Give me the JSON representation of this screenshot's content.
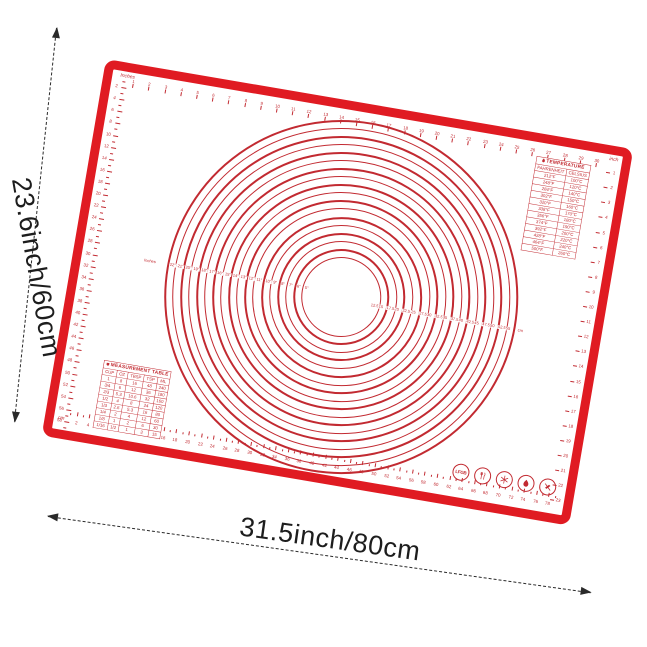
{
  "dimensions": {
    "width_label": "31.5inch/80cm",
    "height_label": "23.6inch/60cm"
  },
  "colors": {
    "mat_red": "#e01b22",
    "print_red": "#c22a31",
    "dimension_text": "#1d1d1d"
  },
  "rulers": {
    "top": {
      "unit_label": "Inches",
      "numbers": [
        1,
        2,
        3,
        4,
        5,
        6,
        7,
        8,
        9,
        10,
        11,
        12,
        13,
        14,
        15,
        16,
        17,
        18,
        19,
        20,
        21,
        22,
        23,
        24,
        25,
        26,
        27,
        28,
        29,
        30
      ]
    },
    "bottom": {
      "unit_label": "cm",
      "numbers": [
        2,
        4,
        6,
        8,
        10,
        12,
        14,
        16,
        18,
        20,
        22,
        24,
        26,
        28,
        30,
        32,
        34,
        36,
        38,
        40,
        42,
        44,
        46,
        48,
        50,
        52,
        54,
        56,
        58,
        60,
        62,
        64,
        66,
        68,
        70,
        72,
        74,
        76,
        78
      ]
    },
    "left": {
      "unit_label": "cm",
      "numbers": [
        2,
        4,
        6,
        8,
        10,
        12,
        14,
        16,
        18,
        20,
        22,
        24,
        26,
        28,
        30,
        32,
        34,
        36,
        38,
        40,
        42,
        44,
        46,
        48,
        50,
        52,
        54,
        56,
        58
      ]
    },
    "right": {
      "unit_label": "inch",
      "numbers": [
        1,
        2,
        3,
        4,
        5,
        6,
        7,
        8,
        9,
        10,
        11,
        12,
        13,
        14,
        15,
        16,
        17,
        18,
        19,
        20,
        21,
        22,
        23
      ]
    }
  },
  "circles": {
    "axis_prefix_label": "Inches",
    "inch_labels": [
      "22\"",
      "21\"",
      "20\"",
      "19\"",
      "18\"",
      "17\"",
      "16\"",
      "15\"",
      "14\"",
      "13\"",
      "12\"",
      "11\"",
      "10\"",
      "9\"",
      "8\"",
      "7\"",
      "6\"",
      "5\""
    ],
    "cm_labels": [
      "12.5",
      "15",
      "17.5",
      "20",
      "22.5",
      "25",
      "27.5",
      "30",
      "32.5",
      "35",
      "37.5",
      "40",
      "42.5",
      "45",
      "47.5",
      "50",
      "52.5",
      "55"
    ],
    "cm_suffix": "cm",
    "count": 18
  },
  "temperature_table": {
    "icon": "flame-icon",
    "title": "TEMPERATURE",
    "columns": [
      "FAHRENHEIT",
      "CELSIUS"
    ],
    "rows": [
      [
        "212°F",
        "100°C"
      ],
      [
        "248°F",
        "120°C"
      ],
      [
        "284°F",
        "140°C"
      ],
      [
        "302°F",
        "150°C"
      ],
      [
        "320°F",
        "160°C"
      ],
      [
        "338°F",
        "170°C"
      ],
      [
        "356°F",
        "180°C"
      ],
      [
        "374°F",
        "190°C"
      ],
      [
        "392°F",
        "200°C"
      ],
      [
        "428°F",
        "220°C"
      ],
      [
        "464°F",
        "240°C"
      ],
      [
        "500°F",
        "260°C"
      ]
    ]
  },
  "measurement_table": {
    "icon": "cup-icon",
    "title": "MEASUREMENT TABLE",
    "columns": [
      "CUP",
      "OZ",
      "TBSP",
      "TSP",
      "ML"
    ],
    "rows": [
      [
        "1",
        "8",
        "16",
        "48",
        "240"
      ],
      [
        "3/4",
        "6",
        "12",
        "36",
        "180"
      ],
      [
        "2/3",
        "5.3",
        "10.6",
        "32",
        "160"
      ],
      [
        "1/2",
        "4",
        "8",
        "24",
        "120"
      ],
      [
        "1/3",
        "2.6",
        "5.3",
        "16",
        "80"
      ],
      [
        "1/4",
        "2",
        "4",
        "12",
        "60"
      ],
      [
        "1/8",
        "1",
        "2",
        "6",
        "30"
      ],
      [
        "1/16",
        "1/2",
        "1",
        "3",
        "15"
      ]
    ]
  },
  "badges": {
    "lfgb_label": "LFGB",
    "items": [
      "lfgb-certified",
      "food-safe-utensils",
      "freezer-safe",
      "heat-resistant",
      "do-not-cut"
    ]
  }
}
